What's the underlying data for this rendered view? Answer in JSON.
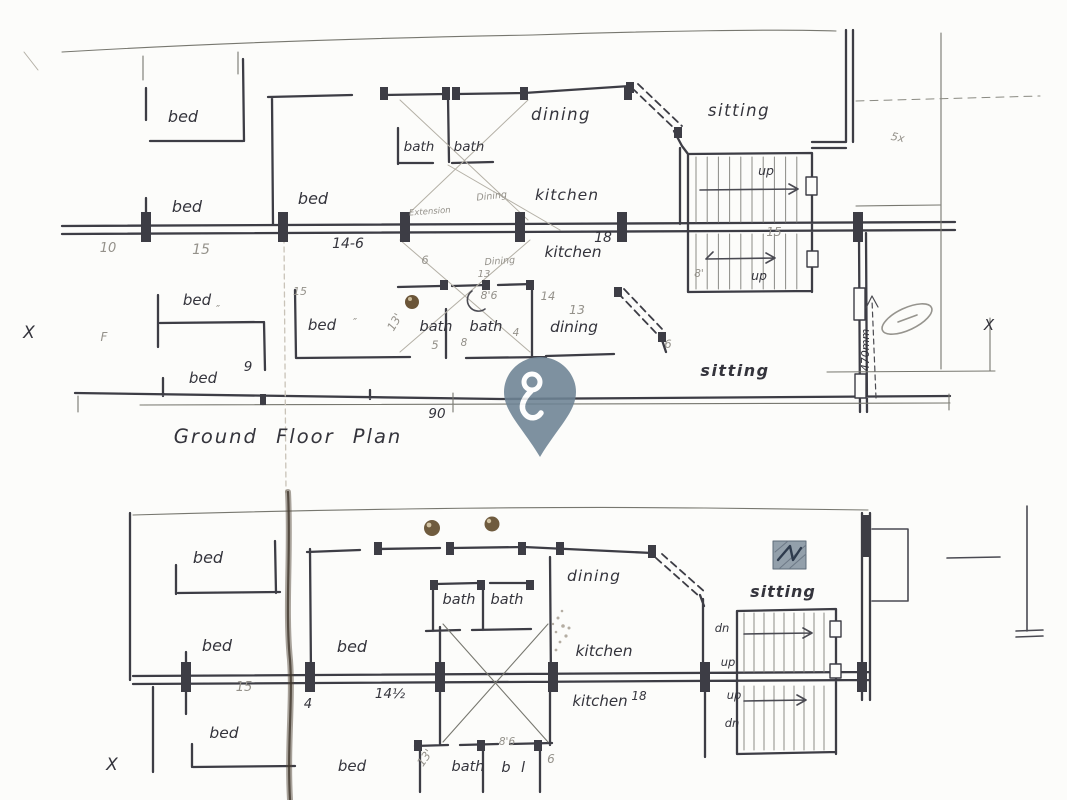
{
  "document": {
    "title": "Ground Floor Plan"
  },
  "colors": {
    "paper": "#fcfcfa",
    "ink": "#3d3d45",
    "ink_text": "#34343c",
    "pencil_text": "#94918a",
    "pin": "#6d8394",
    "pin_glyph": "#ffffff",
    "pushpin_dot": "#6e5a3d",
    "hatch_bg": "#93a0ab",
    "hatch_stroke": "#2e3b4d",
    "smudge": "#53483a"
  },
  "marker": {
    "name": "location-pin",
    "label": "location pin"
  },
  "labels": [
    {
      "t": "bed",
      "x": 183,
      "y": 122,
      "s": 16,
      "n": "room-label-bed"
    },
    {
      "t": "bath",
      "x": 419,
      "y": 151,
      "s": 13.5,
      "n": "room-label-bath"
    },
    {
      "t": "bath",
      "x": 469,
      "y": 151,
      "s": 13.5,
      "n": "room-label-bath"
    },
    {
      "t": "dining",
      "x": 561,
      "y": 120,
      "s": 16.5,
      "ls": 1.5,
      "n": "room-label-dining"
    },
    {
      "t": "sitting",
      "x": 739,
      "y": 116,
      "s": 16.5,
      "ls": 1.5,
      "n": "room-label-sitting"
    },
    {
      "t": "bed",
      "x": 187,
      "y": 212,
      "s": 16,
      "n": "room-label-bed"
    },
    {
      "t": "bed",
      "x": 313,
      "y": 204,
      "s": 16,
      "n": "room-label-bed"
    },
    {
      "t": "kitchen",
      "x": 567,
      "y": 200,
      "s": 15.5,
      "ls": 1,
      "n": "room-label-kitchen"
    },
    {
      "t": "up",
      "x": 766,
      "y": 175,
      "s": 12.5,
      "n": "stair-label-up"
    },
    {
      "t": "10",
      "x": 108,
      "y": 252,
      "s": 13,
      "c": "pencil",
      "n": "dim-label"
    },
    {
      "t": "15",
      "x": 201,
      "y": 254,
      "s": 14,
      "c": "pencil",
      "n": "dim-label"
    },
    {
      "t": "14-6",
      "x": 348,
      "y": 248,
      "s": 14,
      "n": "dim-label"
    },
    {
      "t": "kitchen",
      "x": 573,
      "y": 257,
      "s": 15.5,
      "n": "room-label-kitchen"
    },
    {
      "t": "18",
      "x": 603,
      "y": 242,
      "s": 14,
      "n": "dim-label"
    },
    {
      "t": "15",
      "x": 774,
      "y": 236,
      "s": 12,
      "c": "pencil",
      "n": "dim-label"
    },
    {
      "t": "up",
      "x": 759,
      "y": 280,
      "s": 12.5,
      "n": "stair-label-up"
    },
    {
      "t": "8'",
      "x": 699,
      "y": 277,
      "s": 10.5,
      "c": "pencil",
      "n": "dim-label"
    },
    {
      "t": "bed",
      "x": 197,
      "y": 305,
      "s": 15,
      "n": "room-label-bed"
    },
    {
      "t": "15",
      "x": 300,
      "y": 295,
      "s": 11,
      "c": "pencil",
      "n": "dim-label"
    },
    {
      "t": "″",
      "x": 218,
      "y": 313,
      "s": 11,
      "c": "pencil",
      "n": "ditto-mark"
    },
    {
      "t": "bed",
      "x": 322,
      "y": 330,
      "s": 15,
      "n": "room-label-bed"
    },
    {
      "t": "″",
      "x": 355,
      "y": 326,
      "s": 11,
      "c": "pencil",
      "n": "ditto-mark"
    },
    {
      "t": "13'",
      "x": 398,
      "y": 324,
      "s": 11.5,
      "r": -60,
      "c": "pencil",
      "n": "dim-label"
    },
    {
      "t": "bath",
      "x": 436,
      "y": 331,
      "s": 14.5,
      "n": "room-label-bath"
    },
    {
      "t": "bath",
      "x": 486,
      "y": 331,
      "s": 14.5,
      "n": "room-label-bath"
    },
    {
      "t": "8'6",
      "x": 489,
      "y": 299,
      "s": 11,
      "c": "pencil",
      "n": "dim-label"
    },
    {
      "t": "14",
      "x": 548,
      "y": 300,
      "s": 11.5,
      "c": "pencil",
      "n": "dim-label"
    },
    {
      "t": "13",
      "x": 577,
      "y": 314,
      "s": 12.5,
      "c": "pencil",
      "n": "dim-label"
    },
    {
      "t": "dining",
      "x": 574,
      "y": 332,
      "s": 15.5,
      "n": "room-label-dining"
    },
    {
      "t": "5",
      "x": 435,
      "y": 349,
      "s": 11.5,
      "c": "pencil",
      "n": "dim-label"
    },
    {
      "t": "8",
      "x": 464,
      "y": 346,
      "s": 10.5,
      "c": "pencil",
      "n": "dim-label"
    },
    {
      "t": "4",
      "x": 516,
      "y": 336,
      "s": 10.5,
      "c": "pencil",
      "n": "dim-label"
    },
    {
      "t": "6",
      "x": 425,
      "y": 264,
      "s": 11.5,
      "c": "pencil",
      "n": "dim-label"
    },
    {
      "t": "6",
      "x": 668,
      "y": 348,
      "s": 11.5,
      "c": "pencil",
      "n": "dim-label"
    },
    {
      "t": "9",
      "x": 248,
      "y": 371,
      "s": 13.5,
      "n": "dim-label"
    },
    {
      "t": "bed",
      "x": 203,
      "y": 383,
      "s": 15,
      "n": "room-label-bed"
    },
    {
      "t": "sitting",
      "x": 735,
      "y": 376,
      "s": 16,
      "w": "bold",
      "ls": 1.5,
      "n": "room-label-sitting"
    },
    {
      "t": "90",
      "x": 437,
      "y": 418,
      "s": 13.5,
      "n": "dim-label"
    },
    {
      "t": "470mm",
      "x": 869,
      "y": 350,
      "s": 11,
      "r": -90,
      "n": "dim-label"
    },
    {
      "t": "X",
      "x": 29,
      "y": 338,
      "s": 17,
      "n": "section-mark"
    },
    {
      "t": "F",
      "x": 104,
      "y": 341,
      "s": 12,
      "c": "pencil",
      "n": "pencil-note"
    },
    {
      "t": "X",
      "x": 989,
      "y": 330,
      "s": 15,
      "n": "section-mark"
    },
    {
      "t": "5x",
      "x": 897,
      "y": 141,
      "s": 11,
      "r": 12,
      "c": "pencil",
      "n": "pencil-note"
    },
    {
      "t": "Dining",
      "x": 492,
      "y": 199,
      "s": 9.5,
      "r": -6,
      "c": "pencil",
      "n": "pencil-note"
    },
    {
      "t": "Extension",
      "x": 430,
      "y": 214,
      "s": 8.5,
      "r": -4,
      "c": "pencil",
      "n": "pencil-note"
    },
    {
      "t": "Dining",
      "x": 500,
      "y": 264,
      "s": 9.5,
      "r": -4,
      "c": "pencil",
      "n": "pencil-note"
    },
    {
      "t": "13",
      "x": 484,
      "y": 277,
      "s": 10,
      "c": "pencil",
      "n": "pencil-note"
    },
    {
      "t": "Ground Floor Plan",
      "x": 288,
      "y": 443,
      "s": 19.5,
      "ls": 2,
      "ws": 10,
      "n": "plan-title"
    },
    {
      "t": "bed",
      "x": 208,
      "y": 563,
      "s": 16,
      "n": "room-label-bed"
    },
    {
      "t": "bed",
      "x": 217,
      "y": 651,
      "s": 16,
      "n": "room-label-bed"
    },
    {
      "t": "bed",
      "x": 224,
      "y": 738,
      "s": 15.5,
      "n": "room-label-bed"
    },
    {
      "t": "bed",
      "x": 352,
      "y": 652,
      "s": 16,
      "n": "room-label-bed"
    },
    {
      "t": "bath",
      "x": 459,
      "y": 604,
      "s": 14.5,
      "n": "room-label-bath"
    },
    {
      "t": "bath",
      "x": 507,
      "y": 604,
      "s": 14.5,
      "n": "room-label-bath"
    },
    {
      "t": "dining",
      "x": 594,
      "y": 581,
      "s": 15.5,
      "ls": 1,
      "n": "room-label-dining"
    },
    {
      "t": "sitting",
      "x": 783,
      "y": 597,
      "s": 16,
      "w": "bold",
      "ls": 1,
      "n": "room-label-sitting"
    },
    {
      "t": "kitchen",
      "x": 604,
      "y": 656,
      "s": 15.5,
      "n": "room-label-kitchen"
    },
    {
      "t": "kitchen",
      "x": 600,
      "y": 706,
      "s": 15,
      "n": "room-label-kitchen"
    },
    {
      "t": "18",
      "x": 639,
      "y": 700,
      "s": 12,
      "n": "dim-label"
    },
    {
      "t": "dn",
      "x": 722,
      "y": 632,
      "s": 11.5,
      "n": "stair-label-dn"
    },
    {
      "t": "up",
      "x": 728,
      "y": 666,
      "s": 11.5,
      "n": "stair-label-up"
    },
    {
      "t": "up",
      "x": 734,
      "y": 699,
      "s": 11.5,
      "n": "stair-label-up"
    },
    {
      "t": "dn",
      "x": 732,
      "y": 727,
      "s": 11.5,
      "n": "stair-label-dn"
    },
    {
      "t": "15",
      "x": 244,
      "y": 691,
      "s": 13,
      "c": "pencil",
      "n": "dim-label"
    },
    {
      "t": "14½",
      "x": 390,
      "y": 698,
      "s": 13.5,
      "n": "dim-label"
    },
    {
      "t": "4",
      "x": 308,
      "y": 708,
      "s": 13,
      "n": "dim-label"
    },
    {
      "t": "X",
      "x": 112,
      "y": 770,
      "s": 17,
      "n": "section-mark"
    },
    {
      "t": "bed",
      "x": 352,
      "y": 771,
      "s": 15,
      "n": "room-label-bed"
    },
    {
      "t": "13'",
      "x": 428,
      "y": 760,
      "s": 11.5,
      "r": -55,
      "c": "pencil",
      "n": "dim-label"
    },
    {
      "t": "bath",
      "x": 468,
      "y": 771,
      "s": 14.5,
      "n": "room-label-bath"
    },
    {
      "t": "b",
      "x": 506,
      "y": 772,
      "s": 14.5,
      "n": "room-label-partial"
    },
    {
      "t": "l",
      "x": 523,
      "y": 772,
      "s": 14.5,
      "n": "room-label-partial"
    },
    {
      "t": "6",
      "x": 551,
      "y": 763,
      "s": 12,
      "c": "pencil",
      "n": "dim-label"
    },
    {
      "t": "8'6",
      "x": 507,
      "y": 745,
      "s": 10.5,
      "c": "pencil",
      "n": "dim-label"
    }
  ]
}
